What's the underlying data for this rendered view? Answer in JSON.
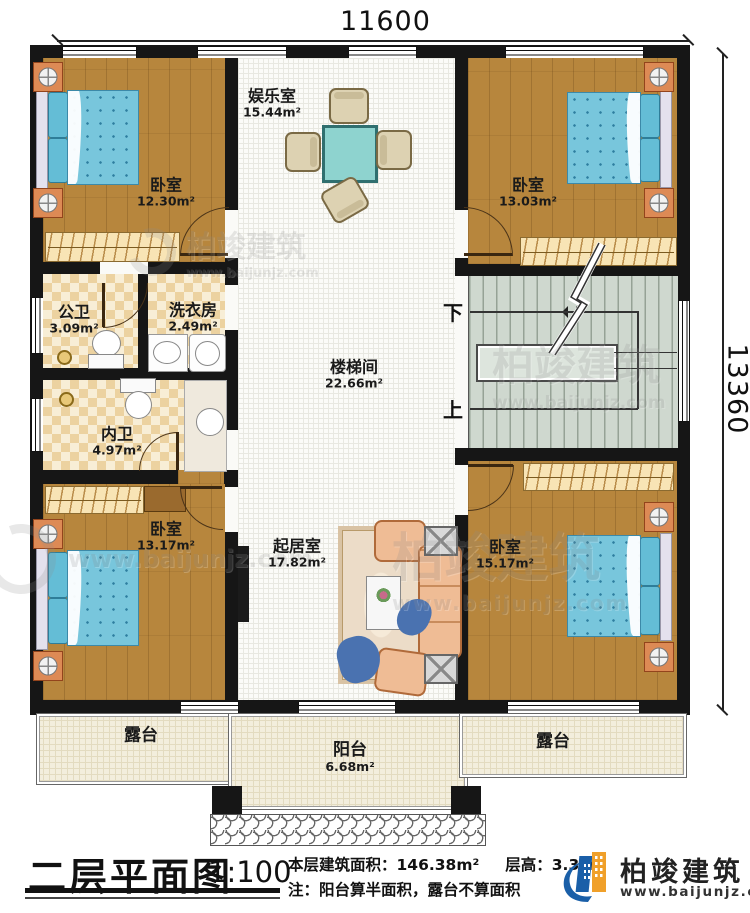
{
  "dimensions": {
    "width_label": "11600",
    "height_label": "13360"
  },
  "rooms": [
    {
      "name": "娱乐室",
      "area": "15.44m²"
    },
    {
      "name": "卧室",
      "area": "12.30m²"
    },
    {
      "name": "卧室",
      "area": "13.03m²"
    },
    {
      "name": "公卫",
      "area": "3.09m²"
    },
    {
      "name": "洗衣房",
      "area": "2.49m²"
    },
    {
      "name": "楼梯间",
      "area": "22.66m²"
    },
    {
      "name": "内卫",
      "area": "4.97m²"
    },
    {
      "name": "卧室",
      "area": "13.17m²"
    },
    {
      "name": "起居室",
      "area": "17.82m²"
    },
    {
      "name": "卧室",
      "area": "15.17m²"
    },
    {
      "name": "露台",
      "area": ""
    },
    {
      "name": "阳台",
      "area": "6.68m²"
    },
    {
      "name": "露台",
      "area": ""
    }
  ],
  "stairs": {
    "down_label": "下",
    "up_label": "上"
  },
  "title_block": {
    "title": "二层平面图",
    "scale": "1:100",
    "area_text": "本层建筑面积：146.38m²",
    "height_text": "层高：3.3m",
    "note_text": "注：阳台算半面积，露台不算面积"
  },
  "brand": {
    "name": "柏竣建筑",
    "website": "www.baijunjz.com"
  },
  "watermark": {
    "name": "柏竣建筑",
    "website": "www.baijunjz.com"
  },
  "colors": {
    "wall": "#161616",
    "wood": "#b7863d",
    "quilt": "#78c6dc",
    "brand_blue": "#1a5fa8",
    "brand_orange": "#f0a02a"
  }
}
